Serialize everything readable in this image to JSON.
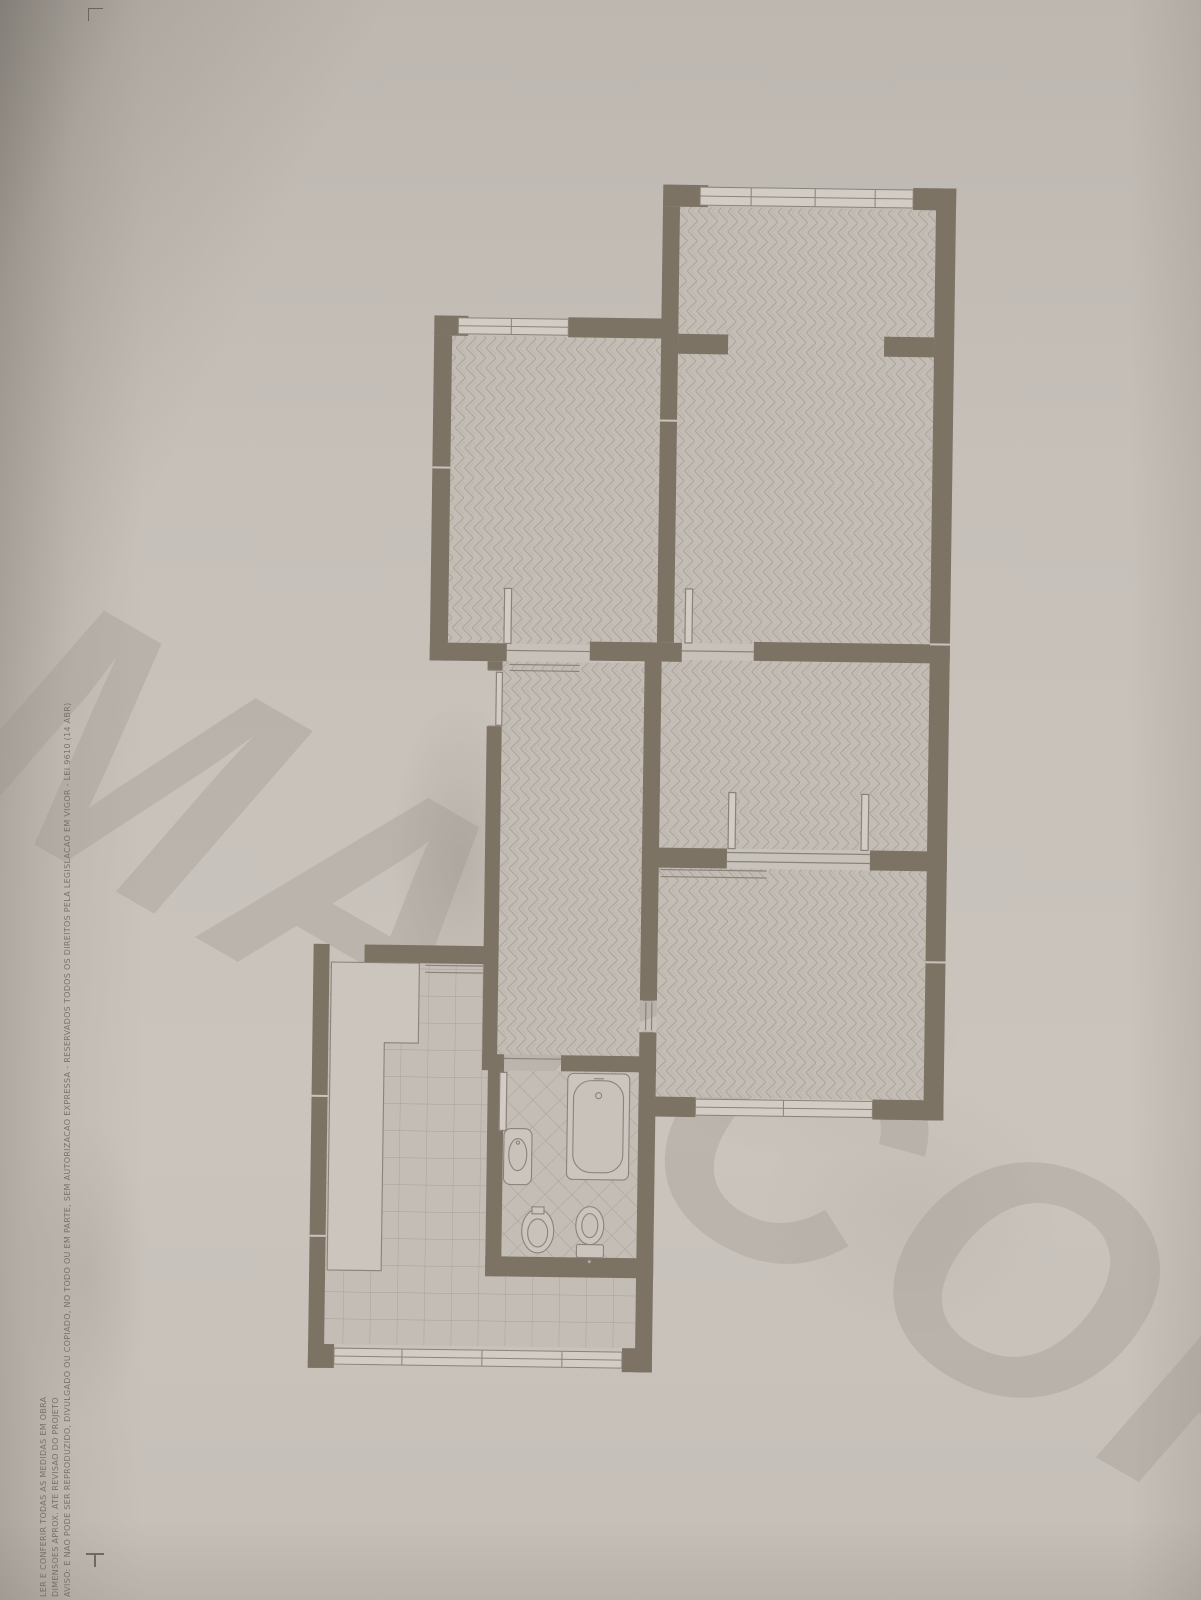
{
  "watermark": {
    "text": "MAYCOR",
    "color": "#999188"
  },
  "margin_text": {
    "color": "#6e675e",
    "lines": [
      "LER E CONFERIR TODAS AS MEDIDAS EM OBRA",
      "DIMENSOES APROX. ATE REVISAO DO PROJETO",
      "AVISO: E NAO PODE SER REPRODUZIDO, DIVULGADO OU COPIADO, NO TODO OU EM PARTE, SEM AUTORIZACAO EXPRESSA - RESERVADOS TODOS OS DIREITOS PELA LEGISLACAO EM VIGOR - LEI 9610 (14 ABR)"
    ]
  },
  "plan": {
    "paper_color": "#c6c0b9",
    "wall_color": "#7c7365",
    "floor_color": "#c3bdb5",
    "floor_line_color": "#a19990",
    "fixture_line_color": "#8b8379",
    "window_fill_color": "#d2ccc5",
    "rooms": [
      {
        "name": "room-top-right",
        "floor": "herringbone-parquet"
      },
      {
        "name": "room-top-left",
        "floor": "herringbone-parquet"
      },
      {
        "name": "room-middle-right",
        "floor": "herringbone-parquet"
      },
      {
        "name": "room-bottom-right",
        "floor": "herringbone-parquet"
      },
      {
        "name": "hallway",
        "floor": "herringbone-parquet"
      },
      {
        "name": "kitchen",
        "floor": "square-tile"
      },
      {
        "name": "bathroom",
        "floor": "diagonal-tile"
      }
    ],
    "fixtures": [
      "bathtub",
      "washbasin",
      "bidet",
      "toilet",
      "kitchen-counter"
    ],
    "features": {
      "windows": 4,
      "door-openings": 7,
      "sliding-door-tracks": 3,
      "wall-stubs": 2
    }
  },
  "marks": {
    "corner_mark": "crop-corner-mark",
    "fold_mark": "fold-tick-mark"
  }
}
